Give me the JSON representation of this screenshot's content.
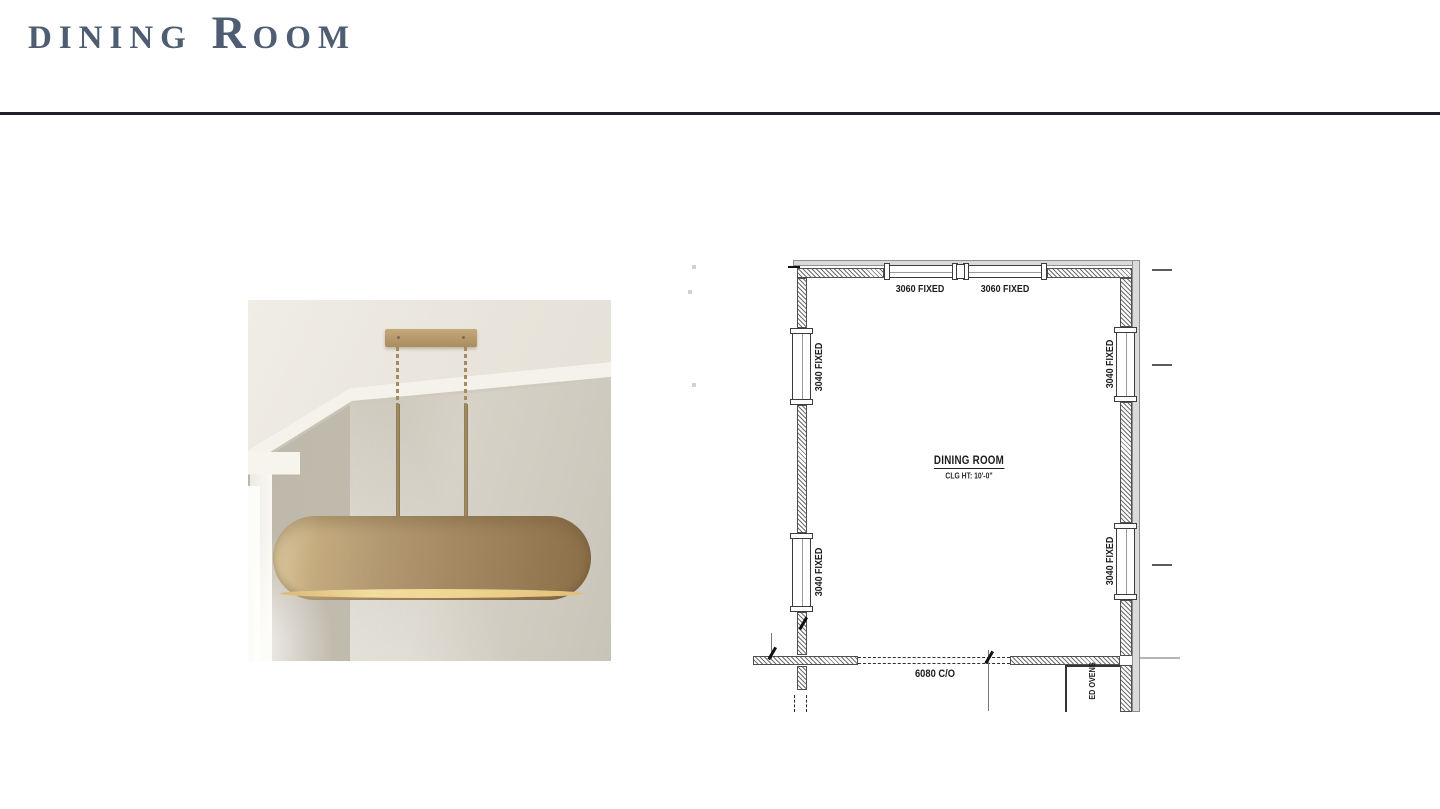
{
  "page": {
    "title": "dining Room"
  },
  "photo": {
    "description": "Brass oval drum linear pendant light hanging from a ceiling canopy by two rods, beside a bright window"
  },
  "floor_plan": {
    "room_name": "DINING ROOM",
    "ceiling_height": "CLG HT: 10'-0\"",
    "opening": "6080 C/O",
    "appliance": "ED OVENS",
    "windows": {
      "top": [
        "3060 FIXED",
        "3060 FIXED"
      ],
      "left": [
        "3040 FIXED",
        "3040 FIXED"
      ],
      "right": [
        "3040 FIXED",
        "3040 FIXED"
      ]
    }
  },
  "colors": {
    "title_text": "#4e5d72",
    "divider": "#20202a",
    "brass": "#ab9166",
    "wall_paint": "#c9c3b7",
    "plan_line": "#3c3c3c"
  }
}
